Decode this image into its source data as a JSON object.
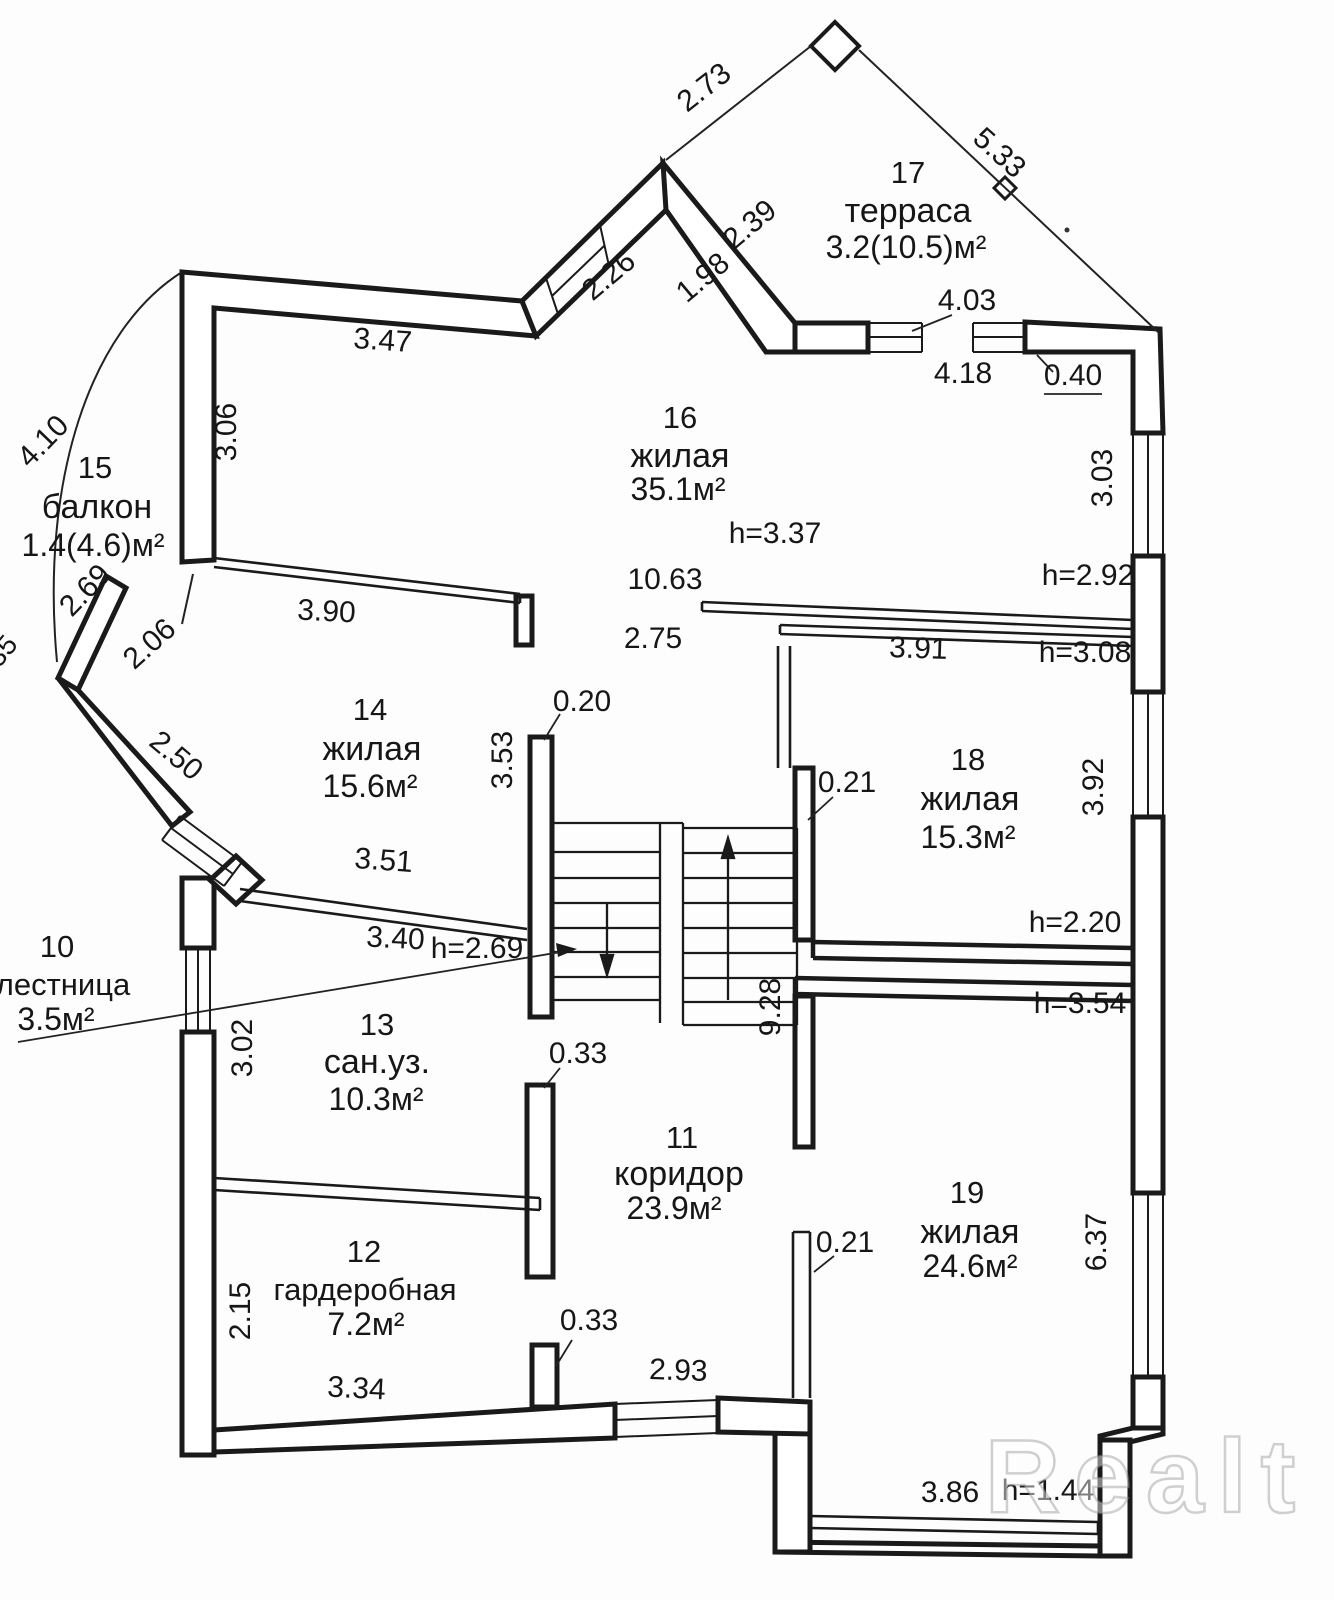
{
  "watermark": "Realt",
  "rooms": {
    "balkon": {
      "number": "15",
      "name": "балкон",
      "area": "1.4(4.6)м²"
    },
    "terrasa": {
      "number": "17",
      "name": "терраса",
      "area": "3.2(10.5)м²"
    },
    "zh16": {
      "number": "16",
      "name": "жилая",
      "area": "35.1м²"
    },
    "zh14": {
      "number": "14",
      "name": "жилая",
      "area": "15.6м²"
    },
    "zh18": {
      "number": "18",
      "name": "жилая",
      "area": "15.3м²"
    },
    "sanuz": {
      "number": "13",
      "name": "сан.уз.",
      "area": "10.3м²"
    },
    "garderob": {
      "number": "12",
      "name": "гардеробная",
      "area": "7.2м²"
    },
    "koridor": {
      "number": "11",
      "name": "коридор",
      "area": "23.9м²"
    },
    "lestnica": {
      "number": "10",
      "name": "лестница",
      "area": "3.5м²"
    },
    "zh19": {
      "number": "19",
      "name": "жилая",
      "area": "24.6м²"
    }
  },
  "heights": {
    "r16": "h=3.37",
    "r16_right": "h=2.92",
    "r18_top": "h=3.08",
    "stair": "h=2.69",
    "r18_bottom": "h=2.20",
    "r19_top": "h=3.54",
    "r19_bottom": "h=1.44"
  },
  "dims": {
    "t273": "2.73",
    "t533": "5.33",
    "t239": "2.39",
    "t226": "2.26",
    "t198": "1.98",
    "t347": "3.47",
    "t403": "4.03",
    "t418": "4.18",
    "t040": "0.40",
    "l306": "3.06",
    "r303": "3.03",
    "arc410": "4.10",
    "arc269": "2.69",
    "arc206": "2.06",
    "arc250": "2.50",
    "arc35": "35",
    "m1063": "10.63",
    "m275": "2.75",
    "m390": "3.90",
    "m391": "3.91",
    "m351": "3.51",
    "m340": "3.40",
    "m020": "0.20",
    "m353": "3.53",
    "r392": "3.92",
    "m021a": "0.21",
    "m928": "9.28",
    "l302": "3.02",
    "m033a": "0.33",
    "l215": "2.15",
    "m033b": "0.33",
    "m334": "3.34",
    "m293": "2.93",
    "m021b": "0.21",
    "r637": "6.37",
    "b386": "3.86"
  }
}
